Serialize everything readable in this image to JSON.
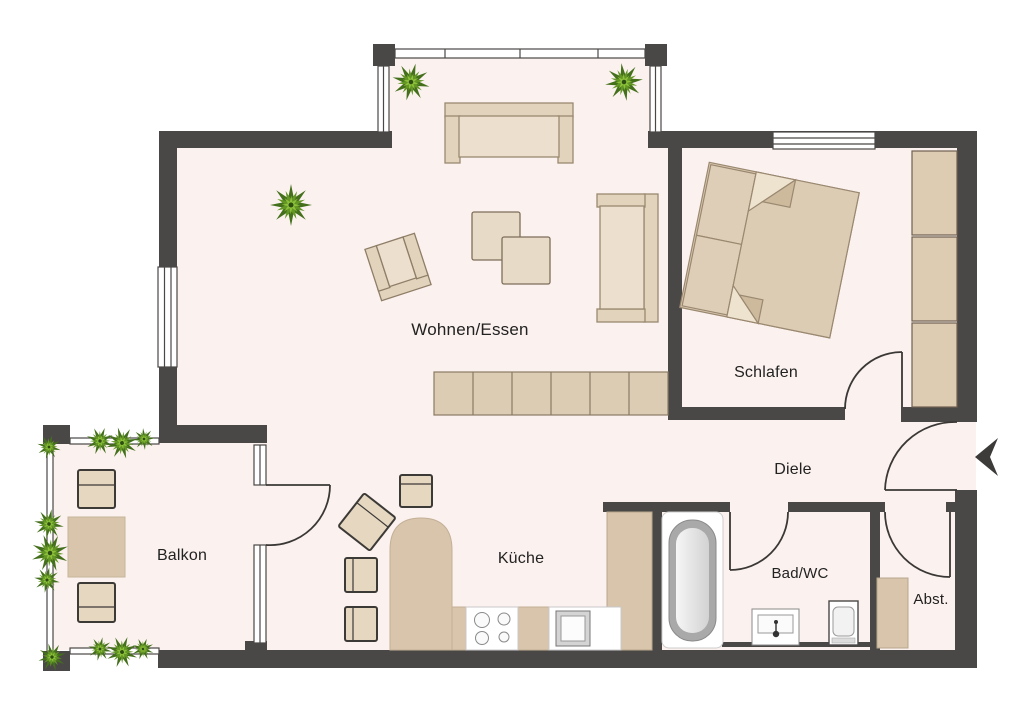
{
  "plan": {
    "type": "apartment-floor-plan",
    "rooms": [
      {
        "id": "wohnen-essen",
        "label": "Wohnen/Essen"
      },
      {
        "id": "schlafen",
        "label": "Schlafen"
      },
      {
        "id": "diele",
        "label": "Diele"
      },
      {
        "id": "balkon",
        "label": "Balkon"
      },
      {
        "id": "kueche",
        "label": "Küche"
      },
      {
        "id": "bad-wc",
        "label": "Bad/WC"
      },
      {
        "id": "abstellraum",
        "label": "Abst."
      }
    ],
    "icons": [
      {
        "name": "plant-icon",
        "meaning": "potted plant / greenery"
      },
      {
        "name": "entrance-arrow-icon",
        "meaning": "apartment entrance direction"
      }
    ],
    "colors": {
      "wall": "#4a4846",
      "floor": "#fbf1ee",
      "furniture_beige": "#e0d1bb",
      "counter_beige": "#d8c5ac",
      "plant_green": "#639625",
      "fixture_white": "#ffffff",
      "label_text": "#222222"
    }
  }
}
